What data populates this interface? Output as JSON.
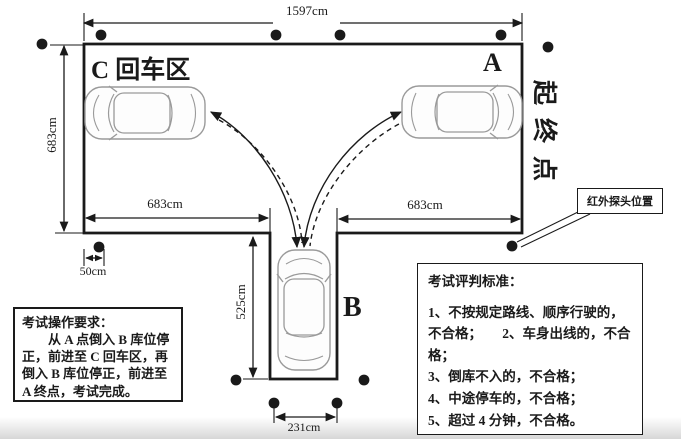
{
  "colors": {
    "line": "#1a1a1a",
    "car_outline": "#9a9a9a"
  },
  "course": {
    "top_dim": "1597cm",
    "left_dim": "683cm",
    "bottom_left_dim": "683cm",
    "bottom_right_dim": "683cm",
    "garage_depth_dim": "525cm",
    "probe_offset_dim": "50cm",
    "garage_width_dim": "231cm",
    "zone_c_label": "C 回车区",
    "point_a_label": "A",
    "point_b_label": "B",
    "start_end_label": "起终点",
    "infrared_label": "红外探头位置"
  },
  "requirements": {
    "title": "考试操作要求：",
    "body": "从 A 点倒入 B 库位停正，前进至 C 回车区，再倒入 B 库位停正，前进至 A 终点，考试完成。"
  },
  "criteria": {
    "title": "考试评判标准：",
    "item_1_2": "1、不按规定路线、顺序行驶的，不合格；　　2、车身出线的，不合格；",
    "item_3": "3、倒库不入的，不合格；",
    "item_4": "4、中途停车的，不合格；",
    "item_5": "5、超过 4 分钟，不合格。"
  }
}
